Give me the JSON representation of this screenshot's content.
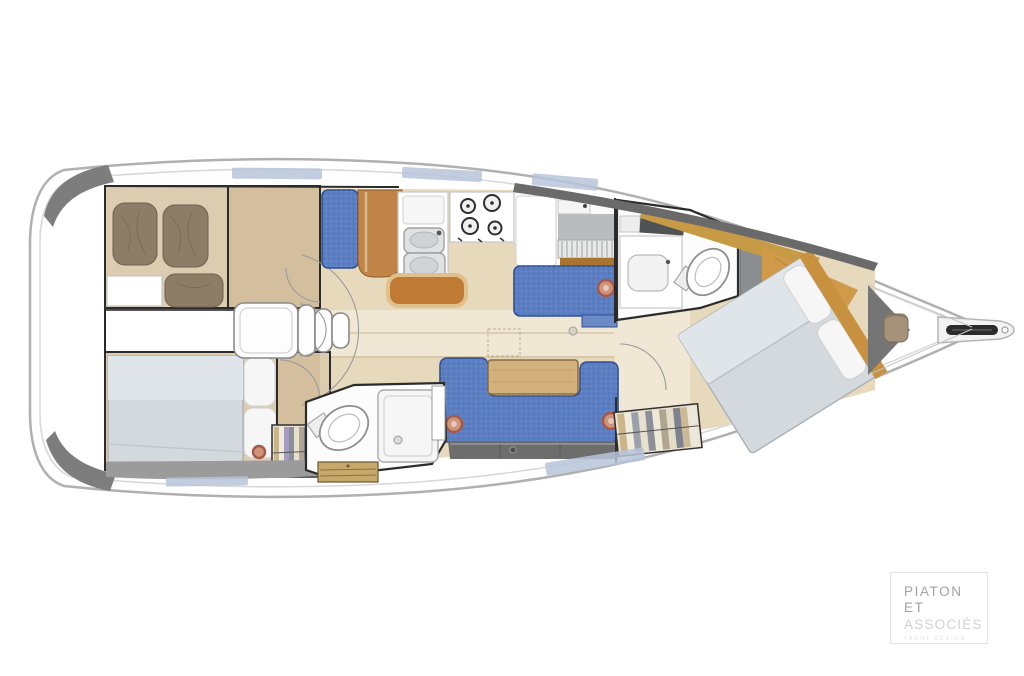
{
  "canvas": {
    "width": 1024,
    "height": 676,
    "background": "#ffffff"
  },
  "colors": {
    "hull-line": "#b0b0b0",
    "deck-line": "#d9d9d9",
    "deck-shadow": "#7d7d7d",
    "top-wall-gray": "#6a6a6a",
    "window-blue": "#b9c4da",
    "floor-wood": "#e7d9bb",
    "floor-light": "#f0e8d4",
    "cabin-wood": "#ddcdb0",
    "wood-mid": "#d3bf9e",
    "teak": "#c08348",
    "bar-orange": "#bf7b35",
    "gold-wood": "#c79a45",
    "upholstery-blue": "#5b7ec2",
    "upholstery-dark": "#2f4f92",
    "bed-gray": "#d3d9dd",
    "sheet-gray": "#e0e5e9",
    "pillow-brown": "#8d7d66",
    "pillow-brown-dark": "#6e6050",
    "locker-gray": "#6d6d6d",
    "hull-band-gray": "#9b9b9b",
    "steel": "#dfe1e3",
    "steel-dark": "#9fa2a4",
    "line-black": "#2b2b2b",
    "red-accent": "#a5584a",
    "red-accent-light": "#cf9579",
    "logo-gray": "#a3a3a3",
    "logo-light": "#d2d2d2",
    "logo-faint": "#e0e0e0"
  },
  "logo": {
    "line1": "PIATON",
    "line2": "ET",
    "line3": "ASSOCIÉS",
    "tagline": "YACHT DESIGN"
  },
  "plan": {
    "type": "boat-interior-floor-plan",
    "orientation": "bow-right",
    "rooms": [
      {
        "id": "aft-cabin-port"
      },
      {
        "id": "aft-cabin-starboard"
      },
      {
        "id": "engine-compartment"
      },
      {
        "id": "companionway-steps"
      },
      {
        "id": "galley"
      },
      {
        "id": "salon"
      },
      {
        "id": "aft-head"
      },
      {
        "id": "forward-head"
      },
      {
        "id": "forward-cabin"
      },
      {
        "id": "bow-anchor-locker"
      }
    ]
  }
}
